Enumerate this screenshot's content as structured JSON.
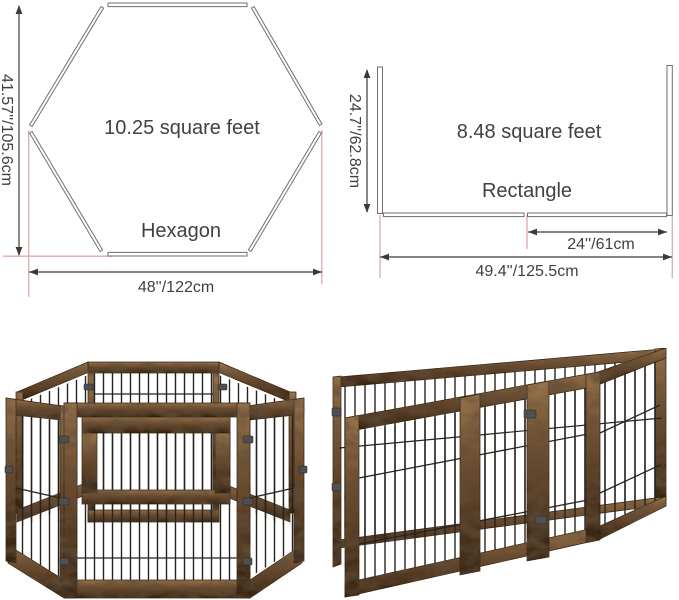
{
  "colors": {
    "diagram_line": "#3a3a3a",
    "shape_outline": "#6f6f6f",
    "diagram_text": "#414141",
    "guide_pink": "#e2a9a9",
    "wood_light": "#96744c",
    "wood_mid": "#64452a",
    "wood_dark": "#352313",
    "wire": "#26221f",
    "hinge_metal": "#4f4f4f"
  },
  "diagrams": {
    "hexagon": {
      "shape_label": "Hexagon",
      "area_label": "10.25 square feet",
      "height_label": "41.57''/105.6cm",
      "width_label": "48''/122cm"
    },
    "rectangle": {
      "shape_label": "Rectangle",
      "area_label": "8.48 square feet",
      "height_label": "24.7''/62.8cm",
      "inner_width_label": "24''/61cm",
      "width_label": "49.4''/125.5cm"
    }
  },
  "photos": {
    "hexagon_pen": "hexagon-wood-wire-pet-pen",
    "rectangle_pen": "rectangle-wood-wire-pet-pen"
  }
}
